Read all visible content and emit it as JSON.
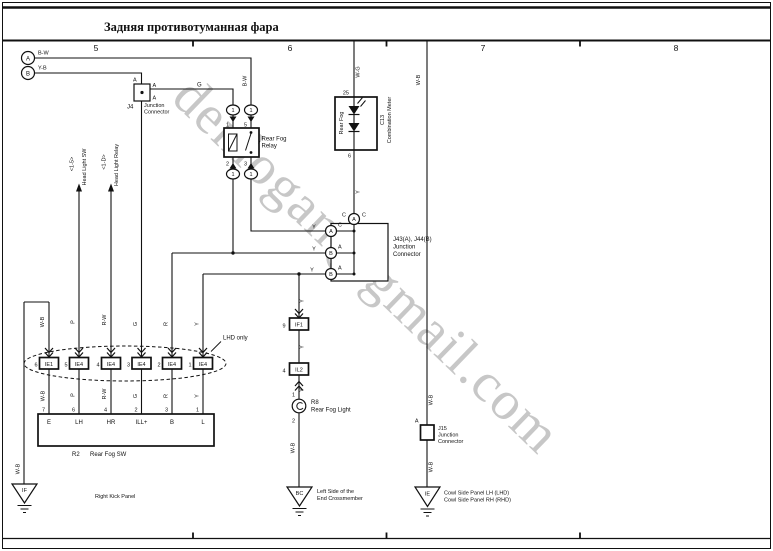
{
  "title": "Задняя противотуманная фара",
  "grid_numbers": [
    "5",
    "6",
    "7",
    "8"
  ],
  "watermark": "denlogan@gmail.com",
  "sources": [
    {
      "id": "A",
      "wire": "B-W"
    },
    {
      "id": "B",
      "wire": "Y-B"
    }
  ],
  "wires": {
    "g": "G",
    "bw_drop": "B-W",
    "meter_feed": "W-G",
    "meter_out": "Y",
    "bus_top": "Y",
    "bus_mid": "Y",
    "bus_bottom": "Y",
    "lamp_1": "Y",
    "lamp_2": "Y",
    "lamp_3": "Y",
    "lamp_ground": "W-B",
    "right_top": "W-B",
    "right_mid": "W-B",
    "right_low": "W-B",
    "left_ground_1": "W-B",
    "left_ground_2": "W-B"
  },
  "j4": {
    "id": "J4",
    "line1": "Junction",
    "line2": "Connector",
    "pin_top": "A",
    "pin_right": "A",
    "pin_bottom": "A"
  },
  "relay": {
    "line1": "Rear Fog",
    "line2": "Relay",
    "pin_1": "1",
    "pin_5": "5",
    "pin_2": "2",
    "pin_3": "3",
    "terminal": "1"
  },
  "meter": {
    "code": "C13",
    "name": "Combination Meter",
    "indicator": "Rear Fog",
    "pin_top": "25",
    "pin_bottom": "6"
  },
  "j43": {
    "name": "J43(A), J44(B)",
    "line1": "Junction",
    "line2": "Connector",
    "top_conn": "A",
    "top_pin_l": "C",
    "top_pin_r": "C",
    "p1_conn": "A",
    "p1_pin": "C",
    "p2_conn": "B",
    "p2_pin": "A",
    "p3_conn": "B",
    "p3_pin": "A"
  },
  "if1": {
    "label": "IF1",
    "pin": "9"
  },
  "il2": {
    "label": "IL2",
    "pin": "4"
  },
  "bulb": {
    "id": "R8",
    "name": "Rear Fog Light",
    "pin_top": "1",
    "pin_bottom": "2"
  },
  "j15": {
    "id": "J15",
    "line1": "Junction",
    "line2": "Connector",
    "pin": "A"
  },
  "grounds": {
    "left": {
      "code": "IF",
      "name": "Right Kick Panel"
    },
    "center": {
      "code": "BC",
      "line1": "Left Side of the",
      "line2": "End Crossmember"
    },
    "right": {
      "code": "IE",
      "line1": "Cowl Side Panel LH (LHD)",
      "line2": "Cowl Side Panel RH (RHD)"
    }
  },
  "lhd_note": "LHD only",
  "harness_row": [
    {
      "pin": "6",
      "label": "IE1"
    },
    {
      "pin": "5",
      "label": "IE4"
    },
    {
      "pin": "4",
      "label": "IE4"
    },
    {
      "pin": "3",
      "label": "IE4"
    },
    {
      "pin": "2",
      "label": "IE4"
    },
    {
      "pin": "1",
      "label": "IE4"
    }
  ],
  "columns": [
    {
      "wire": "W-B"
    },
    {
      "wire": "P",
      "ref": "Head Light SW",
      "ref_code": "<1-5>"
    },
    {
      "wire": "R-W",
      "ref": "Head Light Relay",
      "ref_code": "<1-D>"
    },
    {
      "wire": "G"
    },
    {
      "wire": "R"
    },
    {
      "wire": "Y"
    }
  ],
  "switch": {
    "id": "R2",
    "name": "Rear Fog SW",
    "terminals": [
      {
        "pin": "7",
        "label": "E"
      },
      {
        "pin": "6",
        "label": "LH"
      },
      {
        "pin": "4",
        "label": "HR"
      },
      {
        "pin": "2",
        "label": "ILL+"
      },
      {
        "pin": "3",
        "label": "B"
      },
      {
        "pin": "1",
        "label": "L"
      }
    ]
  }
}
